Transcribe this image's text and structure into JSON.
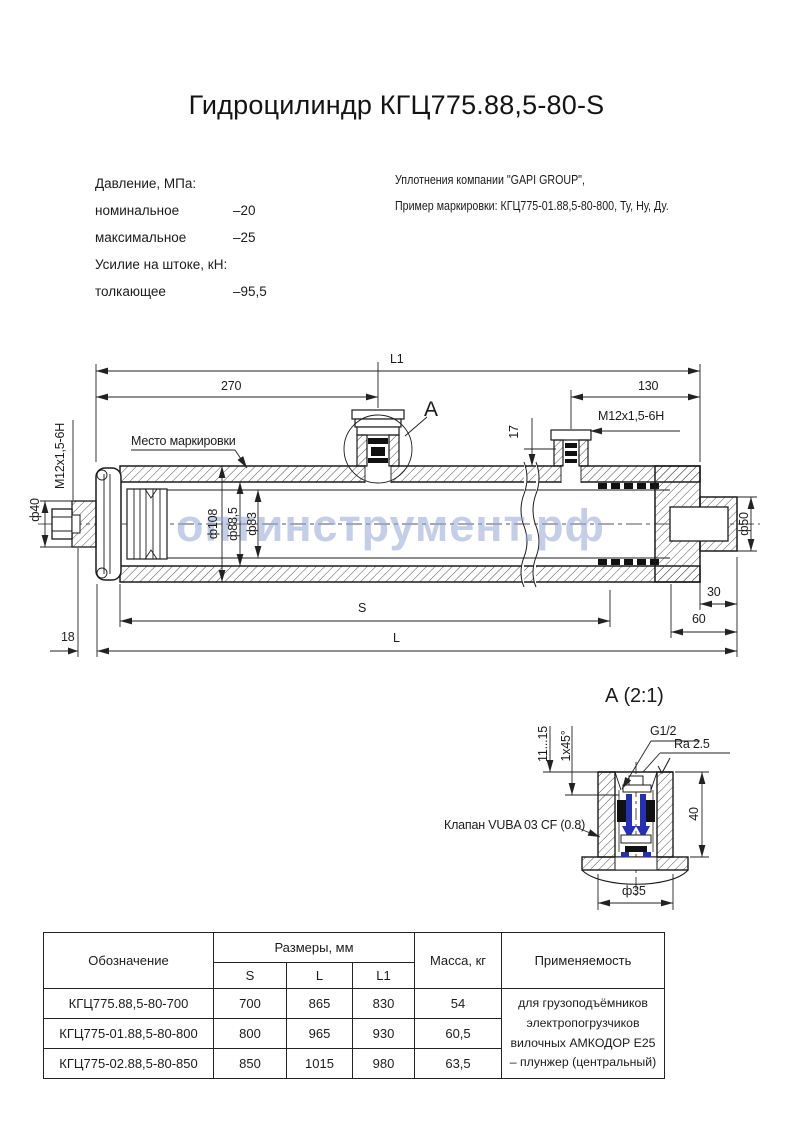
{
  "page": {
    "title": "Гидроцилиндр КГЦ775.88,5-80-S",
    "watermark": "оптинструмент.рф",
    "colors": {
      "watermark": "#96a5d7",
      "valve_accent": "#2531b5",
      "line": "#1b1b1b"
    }
  },
  "specs": {
    "pressure_header": "Давление, МПа:",
    "rows": [
      {
        "label": "номинальное",
        "value": "–20"
      },
      {
        "label": "максимальное",
        "value": "–25"
      }
    ],
    "force_header": "Усилие на штоке, кН:",
    "force_row": {
      "label": "толкающее",
      "value": "–95,5"
    }
  },
  "notes": {
    "line1": "Уплотнения компании \"GAPI GROUP\",",
    "line2": "Пример маркировки: КГЦ775-01.88,5-80-800, Ту, Ну, Ду."
  },
  "main_view": {
    "dim_labels": {
      "l1": "L1",
      "left_span": "270",
      "right_span": "130",
      "port_height": "17",
      "marking_note": "Место маркировки",
      "detail_ref": "А",
      "thread_top": "М12х1,5-6Н",
      "thread_left": "М12х1,5-6Н",
      "dia_bolt": "ф40",
      "dia_outer": "ф108",
      "dia_tube": "ф88,5",
      "dia_plunger": "ф83",
      "dia_rod_end": "ф50",
      "rod_end_len": "30",
      "tail_len": "60",
      "left_offset": "18",
      "stroke": "S",
      "length": "L"
    }
  },
  "detail_view": {
    "title": "А (2:1)",
    "labels": {
      "depth_range": "11...15",
      "chamfer": "1х45°",
      "thread": "G1/2",
      "roughness": "Ra 2.5",
      "height": "40",
      "dia_boss": "ф35",
      "valve_note": "Клапан VUBA 03 CF (0.8)"
    }
  },
  "table": {
    "headers": {
      "designation": "Обозначение",
      "sizes": "Размеры, мм",
      "s": "S",
      "l": "L",
      "l1": "L1",
      "mass": "Масса, кг",
      "application": "Применяемость"
    },
    "rows": [
      {
        "name": "КГЦ775.88,5-80-700",
        "s": "700",
        "l": "865",
        "l1": "830",
        "mass": "54"
      },
      {
        "name": "КГЦ775-01.88,5-80-800",
        "s": "800",
        "l": "965",
        "l1": "930",
        "mass": "60,5"
      },
      {
        "name": "КГЦ775-02.88,5-80-850",
        "s": "850",
        "l": "1015",
        "l1": "980",
        "mass": "63,5"
      }
    ],
    "application_text": "для грузоподъёмников\nэлектропогрузчиков\nвилочных АМКОДОР Е25\n– плунжер (центральный)"
  }
}
